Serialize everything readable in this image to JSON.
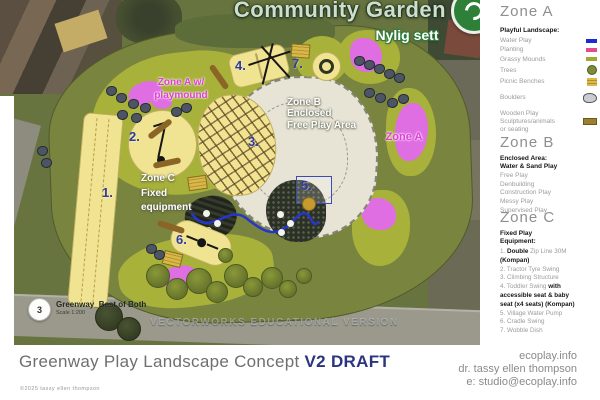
{
  "map": {
    "base_label": "Community Garden",
    "base_sublabel": "Nylig sett",
    "watermark": "VECTORWORKS EDUCATIONAL VERSION",
    "source_ref": {
      "badge": "3",
      "title": "Greenway_Best of Both",
      "subtitle": "Scale 1:200"
    },
    "annotations": {
      "zone_a_mound_1": "Zone A w/",
      "zone_a_mound_2": "playmound",
      "zone_b_1": "Zone B",
      "zone_b_2": "Enclosed",
      "zone_b_3": "Free Play Area",
      "zone_c_1": "Zone C",
      "zone_c_2": "Fixed",
      "zone_c_3": "equipment",
      "zone_a_right": "Zone A",
      "num1": "1.",
      "num2": "2.",
      "num3": "3.",
      "num4": "4.",
      "num5": "5.",
      "num6": "6.",
      "num7": "7."
    }
  },
  "sidebar": {
    "zone_a": {
      "heading": "Zone A",
      "legend_title": "Playful Landscape:",
      "items": [
        {
          "label": "Water Play",
          "color": "#1c2ad4"
        },
        {
          "label": "Planting",
          "color": "#e8498c"
        },
        {
          "label": "Grassy Mounds",
          "color": "#a2a739"
        },
        {
          "label": "Trees",
          "color": "#7d8c33"
        },
        {
          "label": "Picnic Benches",
          "color": "#ddb94b"
        }
      ],
      "boulders_label": "Boulders",
      "boulders_color": "#c9ccd2",
      "wooden_label_1": "Wooden Play",
      "wooden_label_2": "Sculptures/animals",
      "wooden_label_3": "or seating",
      "wooden_color": "#9c8030"
    },
    "zone_b": {
      "heading": "Zone B",
      "bold_lines": [
        "Enclosed Area:",
        "Water & Sand Play"
      ],
      "items": [
        "Free Play",
        "Denbuilding",
        "Construction Play",
        "Messy Play",
        "Supervised Play"
      ]
    },
    "zone_c": {
      "heading": "Zone C",
      "title_1": "Fixed Play",
      "title_2": "Equipment:",
      "item1_pre": "1. ",
      "item1_bold": "Double",
      "item1_post": " Zip Line 30M",
      "item1_kompan": "(Kompan)",
      "item2": "2. Tractor Tyre Swing",
      "item3": "3. Climbing Structure",
      "item4_pre": "4. Toddler Swing ",
      "item4_bold": "with",
      "item4_line2": "accessible seat & baby",
      "item4_line3": "seat (x4 seats) (Kompan)",
      "item5": "5. Village Water Pump",
      "item6": "6. Cradle Swing",
      "item7": "7. Wobble Dish"
    }
  },
  "footer": {
    "title": "Greenway Play Landscape Concept ",
    "version": "V2 DRAFT",
    "copyright": "©2025 tassy ellen thompson",
    "contact": [
      "ecoplay.info",
      "dr. tassy ellen thompson",
      "e: studio@ecoplay.info"
    ]
  },
  "colors": {
    "accent_navy": "#2b3480",
    "map_number_navy": "#2e3a9c",
    "magenta_label": "#e03ed6",
    "site_green": "#79843f",
    "mound_green": "#a8b13a",
    "play_yellow": "#f0e391",
    "planting_magenta": "#df6ee2",
    "water_blue": "#2636c8",
    "zone_b_surface": "#e7e4d6"
  }
}
